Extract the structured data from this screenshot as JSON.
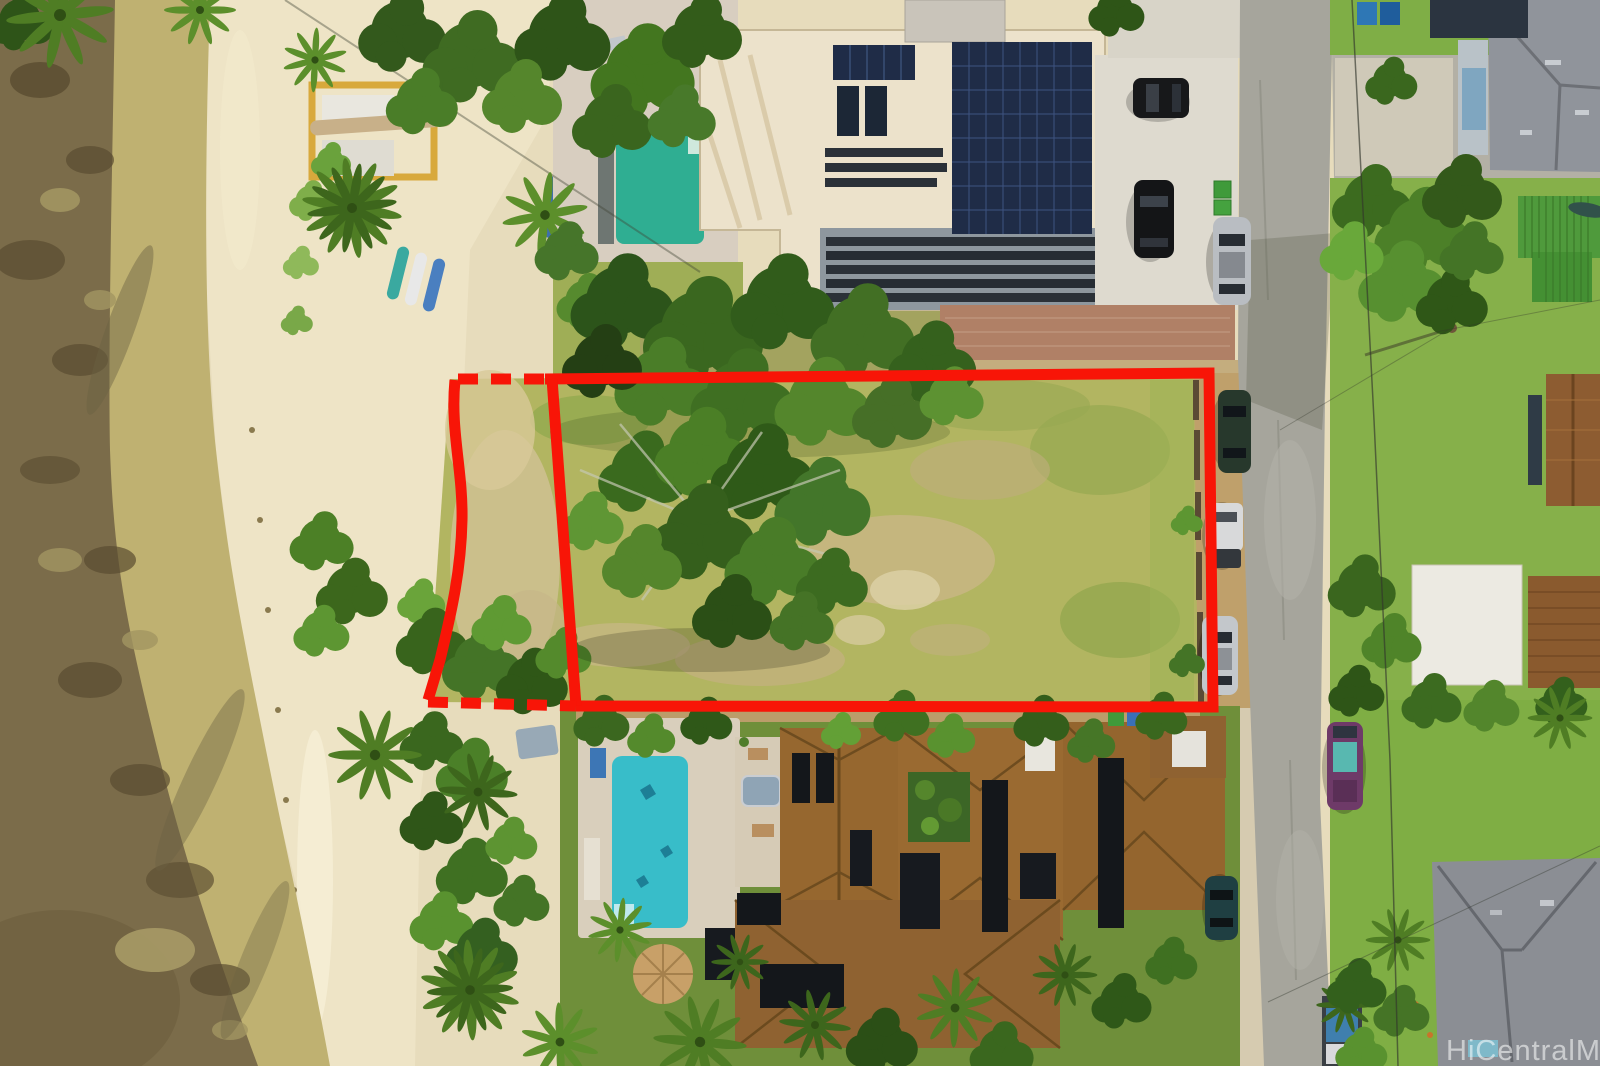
{
  "watermark": {
    "text": "HiCentralMLS"
  },
  "annotation": {
    "type": "property-boundary-outline",
    "color": "#f81507",
    "line_style": "solid with dashed segments on the beach (makai) side"
  },
  "scene": {
    "kind": "aerial-drone-photo",
    "features": [
      "ocean-reef",
      "wet-sand",
      "beach-sand",
      "beach-vegetation",
      "palm-trees",
      "canoe-rack",
      "outrigger-canoe",
      "paddleboards",
      "kayak",
      "vacant-lot-grass",
      "large-tree-in-lot",
      "monkeypod-canopy",
      "top-house-white-roof",
      "solar-panel-arrays",
      "top-house-pool",
      "bottom-house-brown-roof",
      "bottom-house-pool",
      "hot-tub",
      "thatch-umbrella",
      "street",
      "cross-street",
      "parked-cars",
      "trash-bins",
      "rock-wall",
      "gray-roof-house",
      "green-metal-roof",
      "white-shed-roof",
      "utility-pole",
      "power-lines"
    ]
  },
  "colors": {
    "boundary_red": "#f81507",
    "reef_water": "#7b6c4a",
    "wet_sand": "#bfb171",
    "dry_sand": "#eee4c6",
    "lot_grass": "#b2b561",
    "street_asphalt": "#a6a59c",
    "top_pool": "#2fae92",
    "bottom_pool": "#38bdc9",
    "top_house_roof": "#ece2cb",
    "bottom_house_roof": "#96672f",
    "solar_panel": "#1f2c47",
    "watermark_white": "#ffffff"
  }
}
